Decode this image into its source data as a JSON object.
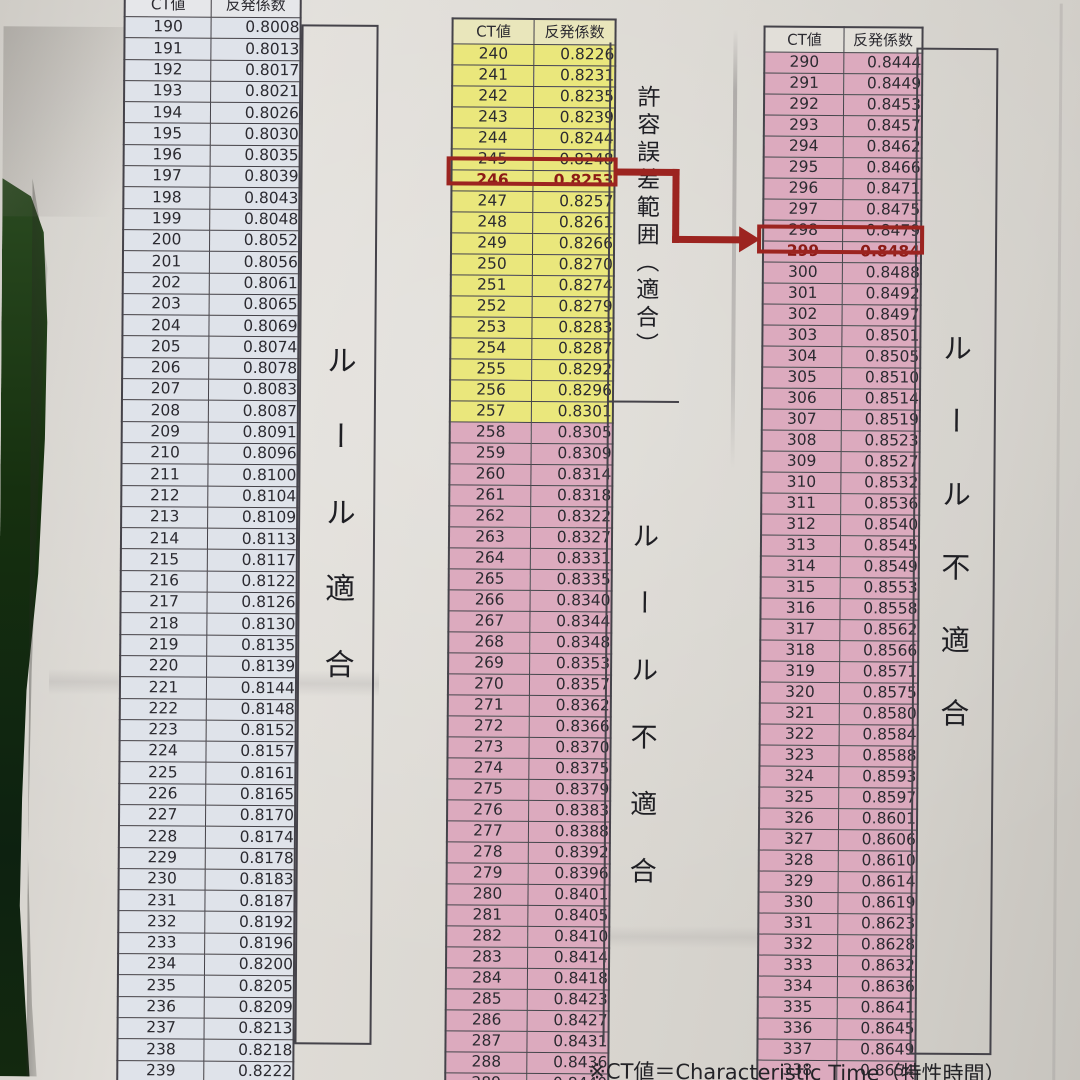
{
  "header": {
    "ct": "CT値",
    "coeff": "反発係数"
  },
  "note": "※CT値＝Characteristic Time（特性時間）",
  "colors": {
    "rule_ok_blue": "#dfe3ea",
    "tolerance_yellow": "#eae77c",
    "violation_pink": "#dcaabe",
    "mid_header_yellow": "#e9e6bb",
    "highlight_red": "#9c2420",
    "table_line": "#45434a",
    "text_dark": "#2c2b31"
  },
  "annotation_arrow": {
    "from": {
      "ct": 246,
      "coeff": "0.8253"
    },
    "to": {
      "ct": 299,
      "coeff": "0.8484"
    }
  },
  "tables": [
    {
      "name": "ct-190-239",
      "zone": "ok",
      "side_label": "ルール適合",
      "rows": [
        [
          190,
          "0.8008"
        ],
        [
          191,
          "0.8013"
        ],
        [
          192,
          "0.8017"
        ],
        [
          193,
          "0.8021"
        ],
        [
          194,
          "0.8026"
        ],
        [
          195,
          "0.8030"
        ],
        [
          196,
          "0.8035"
        ],
        [
          197,
          "0.8039"
        ],
        [
          198,
          "0.8043"
        ],
        [
          199,
          "0.8048"
        ],
        [
          200,
          "0.8052"
        ],
        [
          201,
          "0.8056"
        ],
        [
          202,
          "0.8061"
        ],
        [
          203,
          "0.8065"
        ],
        [
          204,
          "0.8069"
        ],
        [
          205,
          "0.8074"
        ],
        [
          206,
          "0.8078"
        ],
        [
          207,
          "0.8083"
        ],
        [
          208,
          "0.8087"
        ],
        [
          209,
          "0.8091"
        ],
        [
          210,
          "0.8096"
        ],
        [
          211,
          "0.8100"
        ],
        [
          212,
          "0.8104"
        ],
        [
          213,
          "0.8109"
        ],
        [
          214,
          "0.8113"
        ],
        [
          215,
          "0.8117"
        ],
        [
          216,
          "0.8122"
        ],
        [
          217,
          "0.8126"
        ],
        [
          218,
          "0.8130"
        ],
        [
          219,
          "0.8135"
        ],
        [
          220,
          "0.8139"
        ],
        [
          221,
          "0.8144"
        ],
        [
          222,
          "0.8148"
        ],
        [
          223,
          "0.8152"
        ],
        [
          224,
          "0.8157"
        ],
        [
          225,
          "0.8161"
        ],
        [
          226,
          "0.8165"
        ],
        [
          227,
          "0.8170"
        ],
        [
          228,
          "0.8174"
        ],
        [
          229,
          "0.8178"
        ],
        [
          230,
          "0.8183"
        ],
        [
          231,
          "0.8187"
        ],
        [
          232,
          "0.8192"
        ],
        [
          233,
          "0.8196"
        ],
        [
          234,
          "0.8200"
        ],
        [
          235,
          "0.8205"
        ],
        [
          236,
          "0.8209"
        ],
        [
          237,
          "0.8213"
        ],
        [
          238,
          "0.8218"
        ],
        [
          239,
          "0.8222"
        ]
      ]
    },
    {
      "name": "ct-240-289",
      "highlight_ct": 246,
      "zones": [
        {
          "range": [
            240,
            257
          ],
          "zone": "tolerance",
          "side_label": "許容誤差範囲（適合）"
        },
        {
          "range": [
            258,
            289
          ],
          "zone": "violation",
          "side_label": "ルール不適合"
        }
      ],
      "rows": [
        [
          240,
          "0.8226"
        ],
        [
          241,
          "0.8231"
        ],
        [
          242,
          "0.8235"
        ],
        [
          243,
          "0.8239"
        ],
        [
          244,
          "0.8244"
        ],
        [
          245,
          "0.8248"
        ],
        [
          246,
          "0.8253"
        ],
        [
          247,
          "0.8257"
        ],
        [
          248,
          "0.8261"
        ],
        [
          249,
          "0.8266"
        ],
        [
          250,
          "0.8270"
        ],
        [
          251,
          "0.8274"
        ],
        [
          252,
          "0.8279"
        ],
        [
          253,
          "0.8283"
        ],
        [
          254,
          "0.8287"
        ],
        [
          255,
          "0.8292"
        ],
        [
          256,
          "0.8296"
        ],
        [
          257,
          "0.8301"
        ],
        [
          258,
          "0.8305"
        ],
        [
          259,
          "0.8309"
        ],
        [
          260,
          "0.8314"
        ],
        [
          261,
          "0.8318"
        ],
        [
          262,
          "0.8322"
        ],
        [
          263,
          "0.8327"
        ],
        [
          264,
          "0.8331"
        ],
        [
          265,
          "0.8335"
        ],
        [
          266,
          "0.8340"
        ],
        [
          267,
          "0.8344"
        ],
        [
          268,
          "0.8348"
        ],
        [
          269,
          "0.8353"
        ],
        [
          270,
          "0.8357"
        ],
        [
          271,
          "0.8362"
        ],
        [
          272,
          "0.8366"
        ],
        [
          273,
          "0.8370"
        ],
        [
          274,
          "0.8375"
        ],
        [
          275,
          "0.8379"
        ],
        [
          276,
          "0.8383"
        ],
        [
          277,
          "0.8388"
        ],
        [
          278,
          "0.8392"
        ],
        [
          279,
          "0.8396"
        ],
        [
          280,
          "0.8401"
        ],
        [
          281,
          "0.8405"
        ],
        [
          282,
          "0.8410"
        ],
        [
          283,
          "0.8414"
        ],
        [
          284,
          "0.8418"
        ],
        [
          285,
          "0.8423"
        ],
        [
          286,
          "0.8427"
        ],
        [
          287,
          "0.8431"
        ],
        [
          288,
          "0.8436"
        ],
        [
          289,
          "0.8440"
        ]
      ]
    },
    {
      "name": "ct-290-339",
      "zone": "violation",
      "highlight_ct": 299,
      "side_label": "ルール不適合",
      "rows": [
        [
          290,
          "0.8444"
        ],
        [
          291,
          "0.8449"
        ],
        [
          292,
          "0.8453"
        ],
        [
          293,
          "0.8457"
        ],
        [
          294,
          "0.8462"
        ],
        [
          295,
          "0.8466"
        ],
        [
          296,
          "0.8471"
        ],
        [
          297,
          "0.8475"
        ],
        [
          298,
          "0.8479"
        ],
        [
          299,
          "0.8484"
        ],
        [
          300,
          "0.8488"
        ],
        [
          301,
          "0.8492"
        ],
        [
          302,
          "0.8497"
        ],
        [
          303,
          "0.8501"
        ],
        [
          304,
          "0.8505"
        ],
        [
          305,
          "0.8510"
        ],
        [
          306,
          "0.8514"
        ],
        [
          307,
          "0.8519"
        ],
        [
          308,
          "0.8523"
        ],
        [
          309,
          "0.8527"
        ],
        [
          310,
          "0.8532"
        ],
        [
          311,
          "0.8536"
        ],
        [
          312,
          "0.8540"
        ],
        [
          313,
          "0.8545"
        ],
        [
          314,
          "0.8549"
        ],
        [
          315,
          "0.8553"
        ],
        [
          316,
          "0.8558"
        ],
        [
          317,
          "0.8562"
        ],
        [
          318,
          "0.8566"
        ],
        [
          319,
          "0.8571"
        ],
        [
          320,
          "0.8575"
        ],
        [
          321,
          "0.8580"
        ],
        [
          322,
          "0.8584"
        ],
        [
          323,
          "0.8588"
        ],
        [
          324,
          "0.8593"
        ],
        [
          325,
          "0.8597"
        ],
        [
          326,
          "0.8601"
        ],
        [
          327,
          "0.8606"
        ],
        [
          328,
          "0.8610"
        ],
        [
          329,
          "0.8614"
        ],
        [
          330,
          "0.8619"
        ],
        [
          331,
          "0.8623"
        ],
        [
          332,
          "0.8628"
        ],
        [
          333,
          "0.8632"
        ],
        [
          334,
          "0.8636"
        ],
        [
          335,
          "0.8641"
        ],
        [
          336,
          "0.8645"
        ],
        [
          337,
          "0.8649"
        ],
        [
          338,
          "0.8654"
        ],
        [
          339,
          "0.8658"
        ]
      ]
    }
  ]
}
